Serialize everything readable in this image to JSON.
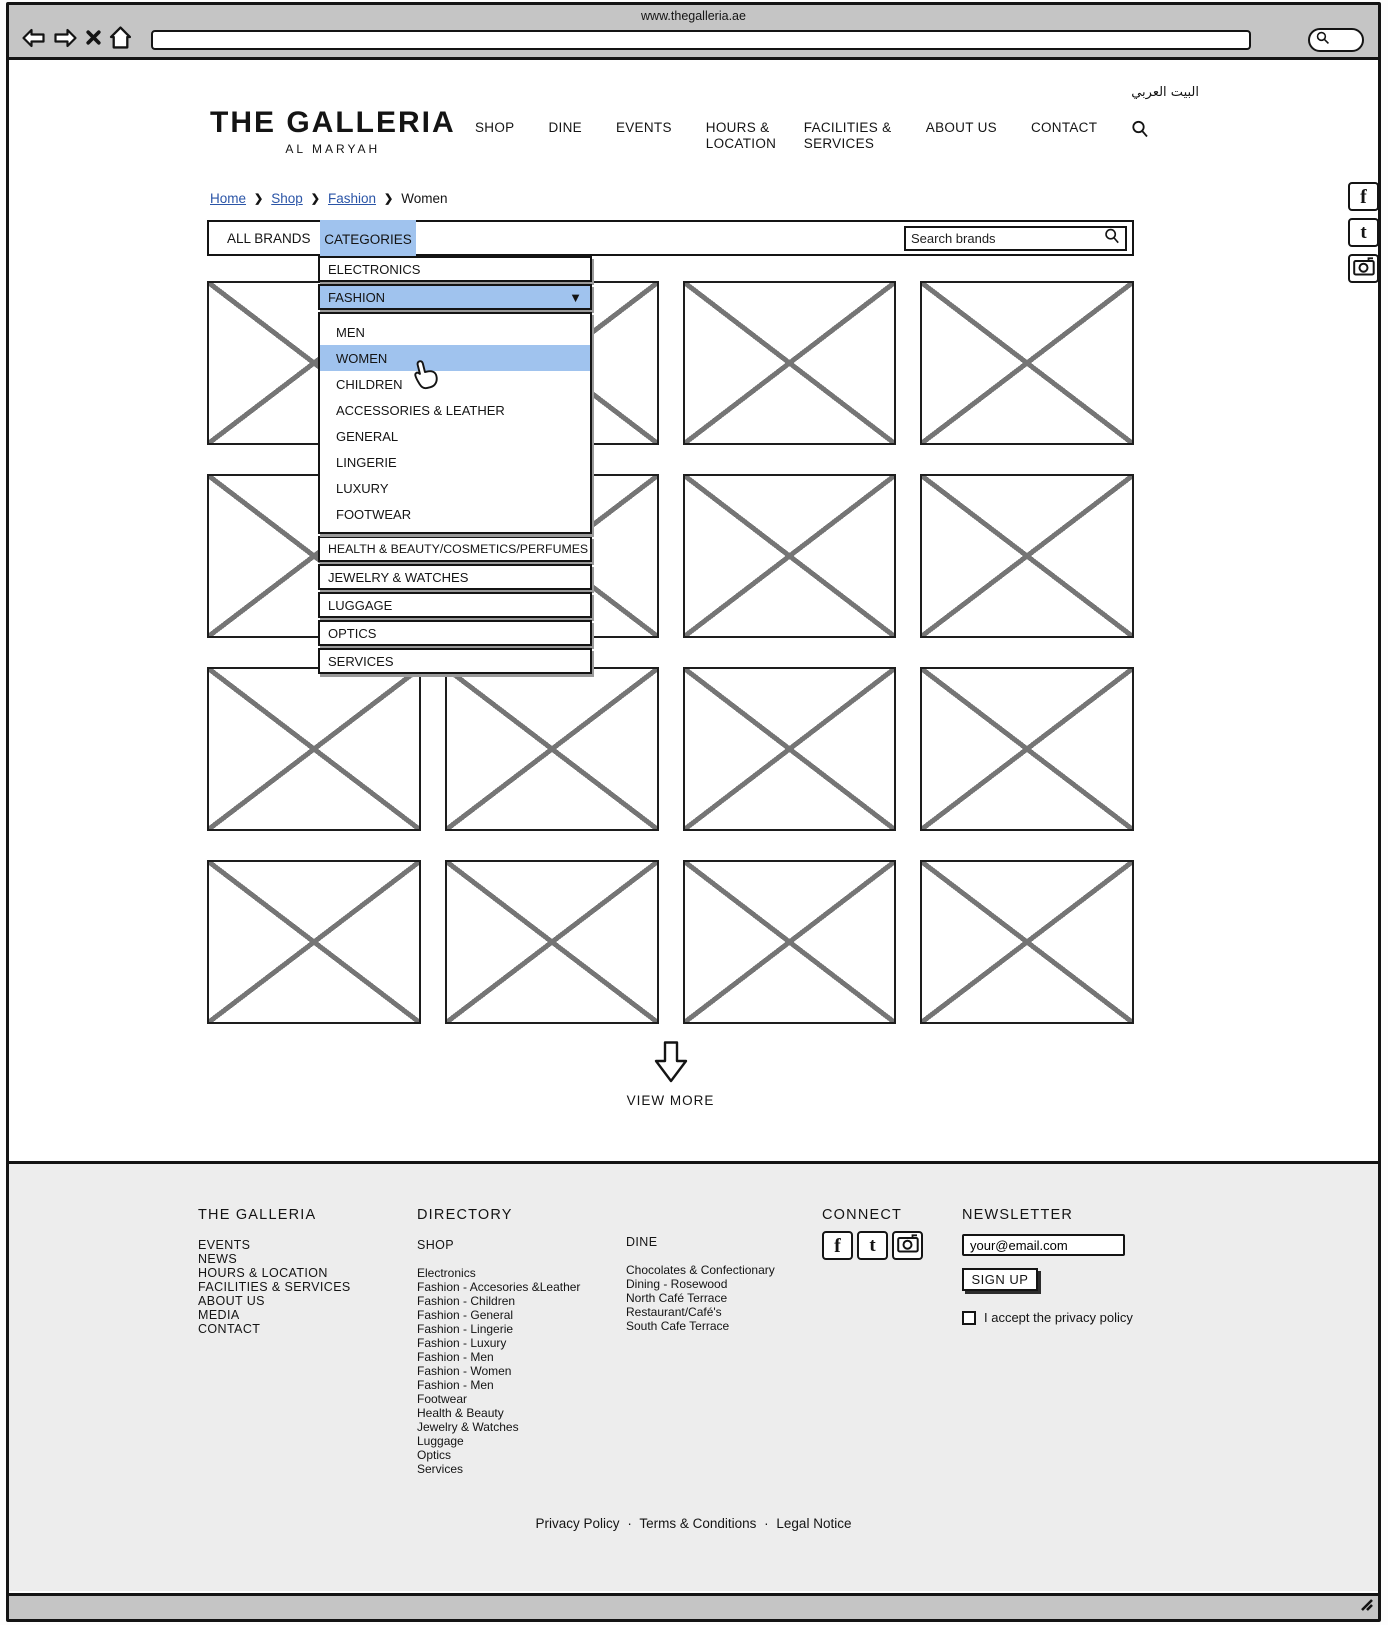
{
  "colors": {
    "highlight_blue": "#a0c3ee",
    "link_blue": "#2b55a7",
    "chrome_gray": "#c5c5c5",
    "footer_gray": "#ededed",
    "border_dark": "#141414",
    "placeholder_x_gray": "#757575"
  },
  "browser": {
    "page_title": "www.thegalleria.ae",
    "address_value": "",
    "toolbar_icons": [
      "back-arrow",
      "forward-arrow",
      "close-x",
      "home",
      "magnifier"
    ]
  },
  "header": {
    "logo_title": "THE GALLERIA",
    "logo_subtitle": "AL MARYAH",
    "arabic_link": "البيت العربي",
    "nav": [
      "SHOP",
      "DINE",
      "EVENTS",
      "HOURS & LOCATION",
      "FACILITIES & SERVICES",
      "ABOUT US",
      "CONTACT"
    ],
    "nav_search_icon": "magnifier"
  },
  "breadcrumb": {
    "links": [
      "Home",
      "Shop",
      "Fashion"
    ],
    "current": "Women",
    "separator": "❯"
  },
  "brand_bar": {
    "tabs": [
      "ALL BRANDS",
      "CATEGORIES"
    ],
    "active_tab": "CATEGORIES",
    "search_placeholder": "Search brands",
    "search_icon": "magnifier"
  },
  "category_menu": {
    "top_items": [
      "ELECTRONICS",
      "FASHION"
    ],
    "expanded_item": "FASHION",
    "expand_icon": "▼",
    "fashion_children": [
      "MEN",
      "WOMEN",
      "CHILDREN",
      "ACCESSORIES & LEATHER",
      "GENERAL",
      "LINGERIE",
      "LUXURY",
      "FOOTWEAR"
    ],
    "highlighted_child": "WOMEN",
    "bottom_items": [
      "HEALTH & BEAUTY/COSMETICS/PERFUMES",
      "JEWELRY & WATCHES",
      "LUGGAGE",
      "OPTICS",
      "SERVICES"
    ]
  },
  "view_more_label": "VIEW MORE",
  "social_sidebar_icons": [
    "facebook",
    "twitter",
    "camera"
  ],
  "footer": {
    "galleria": {
      "heading": "THE GALLERIA",
      "items": [
        "EVENTS",
        "NEWS",
        "HOURS & LOCATION",
        "FACILITIES & SERVICES",
        "ABOUT US",
        "MEDIA",
        "CONTACT"
      ]
    },
    "directory": {
      "heading": "DIRECTORY",
      "subheading": "SHOP",
      "shop_items": [
        "Electronics",
        "Fashion - Accesories &Leather",
        "Fashion - Children",
        "Fashion - General",
        "Fashion - Lingerie",
        "Fashion - Luxury",
        "Fashion - Men",
        "Fashion - Women",
        "Fashion - Men",
        "Footwear",
        "Health & Beauty",
        "Jewelry & Watches",
        "Luggage",
        "Optics",
        "Services"
      ]
    },
    "dine": {
      "heading": "DINE",
      "items": [
        "Chocolates & Confectionary",
        "Dining - Rosewood",
        "North Café Terrace",
        "Restaurant/Café's",
        "South Cafe Terrace"
      ]
    },
    "connect": {
      "heading": "CONNECT",
      "icons": [
        "facebook",
        "twitter",
        "camera"
      ]
    },
    "newsletter": {
      "heading": "NEWSLETTER",
      "email_value": "your@email.com",
      "signup_label": "SIGN UP",
      "privacy_label": "I accept the privacy policy",
      "privacy_checked": false
    },
    "legal_links": [
      "Privacy Policy",
      "Terms & Conditions",
      "Legal Notice"
    ],
    "legal_separator": "·"
  }
}
